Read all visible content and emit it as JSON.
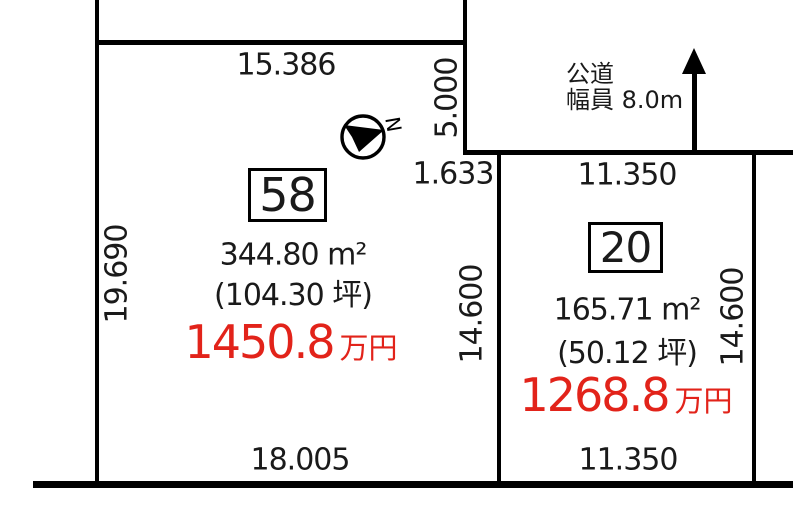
{
  "theme": {
    "line_color": "#000000",
    "text_color": "#1a1a1a",
    "price_color": "#e2231a",
    "background_color": "#ffffff"
  },
  "road": {
    "label_line1": "公道",
    "label_line2": "幅員 8.0m",
    "north_label": "N"
  },
  "parcels": [
    {
      "id": "parcel-58",
      "number": "58",
      "area_m2": "344.80 m²",
      "area_tsubo": "(104.30 坪)",
      "price_value": "1450.8",
      "price_unit": "万円",
      "dimensions": {
        "top": "15.386",
        "left": "19.690",
        "right_upper": "5.000",
        "right_offset": "1.633",
        "right_lower": "14.600",
        "bottom": "18.005"
      }
    },
    {
      "id": "parcel-20",
      "number": "20",
      "area_m2": "165.71 m²",
      "area_tsubo": "(50.12 坪)",
      "price_value": "1268.8",
      "price_unit": "万円",
      "dimensions": {
        "top": "11.350",
        "right": "14.600",
        "bottom": "11.350"
      }
    }
  ]
}
